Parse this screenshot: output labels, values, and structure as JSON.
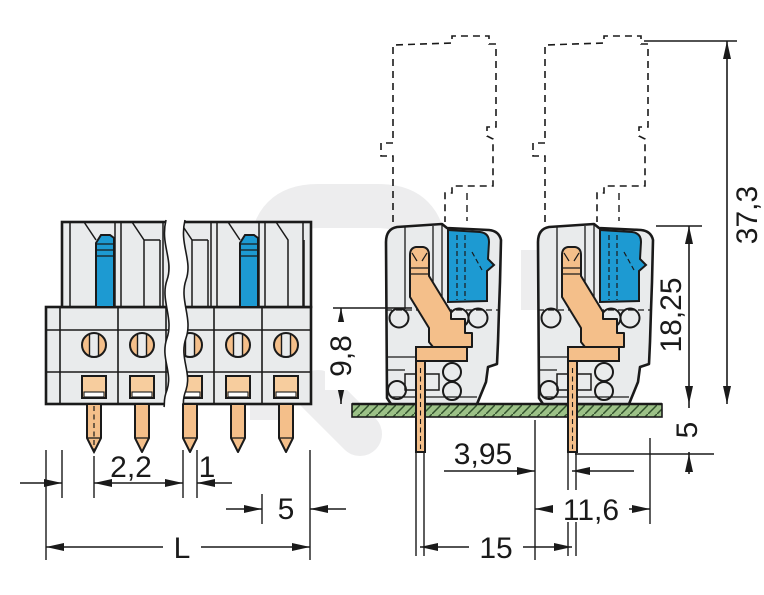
{
  "dimensions": {
    "front": {
      "pin_group_width": "2,2",
      "pin_width": "1",
      "last_pitch": "5",
      "total_length": "L"
    },
    "side": {
      "height_above_board": "9,8",
      "overall_height_with_plug": "37,3",
      "housing_height": "18,25",
      "pin_length_below_board": "5",
      "pin_to_front": "3,95",
      "housing_depth": "11,6",
      "pin_spacing_shown": "15"
    }
  },
  "colors": {
    "blue": "#1d9ad2",
    "copper": "#f4bf8a",
    "copper_light": "#f7cd9e",
    "pcb_green": "#9cc187",
    "hatch": "#31512c",
    "body_gray": "#e9ebec",
    "body_gray_dark": "#dcdfe2",
    "outline": "#1a1a1a",
    "watermark": "#ededee",
    "dim_color": "#1a1a1a"
  }
}
